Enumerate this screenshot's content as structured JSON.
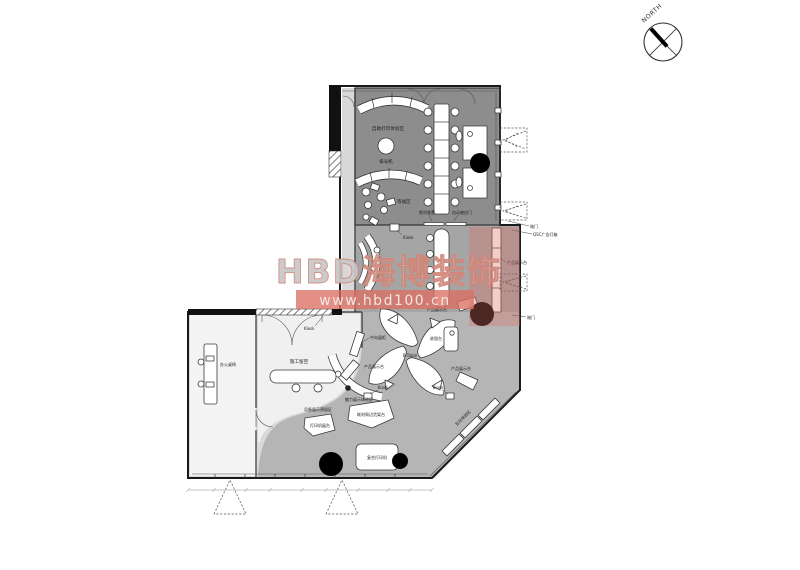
{
  "watermark": {
    "brand": "HBD海博装饰",
    "url": "www.hbd100.cn"
  },
  "compass": {
    "label": "NORTH"
  },
  "colors": {
    "dark_room": "#8d8d8d",
    "mid_room": "#a5a5a5",
    "showroom": "#b5b5b5",
    "corridor": "#d9d9d9",
    "watermark_red": "#dd6f63"
  },
  "labels": {
    "self_service_area": "自助打印体验区",
    "queue_machine": "排号机",
    "waiting_area": "等候区",
    "display_unit": "陈列装置",
    "auto_door": "自动感应门",
    "hidden_door_top": "暗门",
    "ad_lightbox": "QSC广告灯箱",
    "product_display_right": "产品展示台",
    "hidden_door_mid": "暗门",
    "kiosk_1": "Kiosk",
    "kiosk_2": "Kiosk",
    "kiosk_3": "Kiosk",
    "kiosk_4": "Kiosk",
    "island_showcase": "中岛展柜",
    "product_display_left": "产品展示台",
    "product_display_ne": "产品展示台",
    "product_display_se": "产品展示台",
    "b_table": "B-Table",
    "cashier": "收银台",
    "office_desk": "办公桌椅",
    "construction_void": "施工留空",
    "charm_display": "魅力展示体验区",
    "equipment_reserve": "设备展示预留区",
    "printer_stand": "打印机展台",
    "consumables_shelf": "耗材周边货架台",
    "mfp": "复合打印机",
    "interactive_zone": "互动体验区"
  }
}
